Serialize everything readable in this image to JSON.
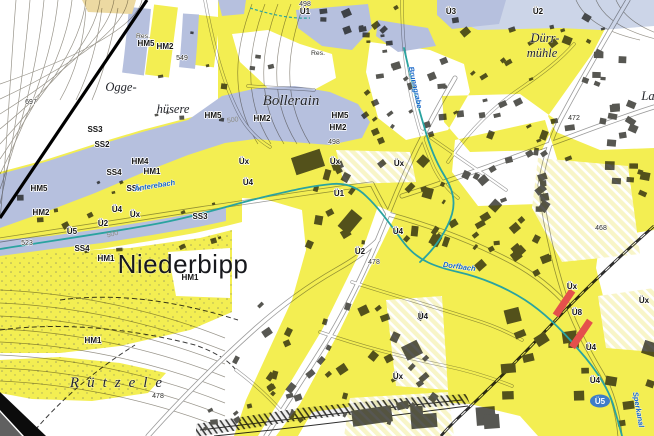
{
  "map": {
    "colors": {
      "yellow": "#f3ee52",
      "paleYellow": "#f8f5c8",
      "blue": "#b6c0de",
      "lightBlue": "#ccd5e8",
      "tan": "#ecd9a2",
      "red": "#e4504c",
      "stream": "#2aa3a0",
      "waterText": "#1565c8",
      "building": "#575752",
      "roadCasing": "#9b9b9b",
      "contour": "#98948a",
      "dots": "#8e9160"
    },
    "labels": {
      "hazard_codes": [
        {
          "t": "HM5",
          "x": 146,
          "y": 46
        },
        {
          "t": "HM2",
          "x": 165,
          "y": 49
        },
        {
          "t": "Ü1",
          "x": 305,
          "y": 14
        },
        {
          "t": "Ü3",
          "x": 451,
          "y": 14
        },
        {
          "t": "Ü2",
          "x": 538,
          "y": 14
        },
        {
          "t": "HM5",
          "x": 213,
          "y": 118
        },
        {
          "t": "HM2",
          "x": 262,
          "y": 121
        },
        {
          "t": "HM5",
          "x": 340,
          "y": 118
        },
        {
          "t": "HM2",
          "x": 338,
          "y": 130
        },
        {
          "t": "SS3",
          "x": 95,
          "y": 132
        },
        {
          "t": "SS2",
          "x": 102,
          "y": 147
        },
        {
          "t": "HM4",
          "x": 140,
          "y": 164
        },
        {
          "t": "HM1",
          "x": 152,
          "y": 174
        },
        {
          "t": "SS4",
          "x": 114,
          "y": 175
        },
        {
          "t": "SSx",
          "x": 134,
          "y": 191
        },
        {
          "t": "HM5",
          "x": 39,
          "y": 191
        },
        {
          "t": "HM2",
          "x": 41,
          "y": 215
        },
        {
          "t": "Üx",
          "x": 244,
          "y": 164
        },
        {
          "t": "Üx",
          "x": 335,
          "y": 164
        },
        {
          "t": "Üx",
          "x": 399,
          "y": 166
        },
        {
          "t": "Ü4",
          "x": 248,
          "y": 185
        },
        {
          "t": "Ü1",
          "x": 339,
          "y": 196
        },
        {
          "t": "Ü4",
          "x": 117,
          "y": 212
        },
        {
          "t": "Üx",
          "x": 135,
          "y": 217
        },
        {
          "t": "Ü2",
          "x": 103,
          "y": 226
        },
        {
          "t": "Ü5",
          "x": 72,
          "y": 234
        },
        {
          "t": "SS3",
          "x": 200,
          "y": 219
        },
        {
          "t": "SS4",
          "x": 82,
          "y": 251
        },
        {
          "t": "HM1",
          "x": 106,
          "y": 261
        },
        {
          "t": "HM1",
          "x": 190,
          "y": 280
        },
        {
          "t": "HM1",
          "x": 93,
          "y": 343
        },
        {
          "t": "Ü2",
          "x": 360,
          "y": 254
        },
        {
          "t": "Ü4",
          "x": 398,
          "y": 234
        },
        {
          "t": "Ü4",
          "x": 423,
          "y": 319
        },
        {
          "t": "Üx",
          "x": 398,
          "y": 379
        },
        {
          "t": "Üx",
          "x": 572,
          "y": 289
        },
        {
          "t": "Üx",
          "x": 644,
          "y": 303
        },
        {
          "t": "Ü8",
          "x": 577,
          "y": 315
        },
        {
          "t": "Ü4",
          "x": 591,
          "y": 350
        },
        {
          "t": "Ü4",
          "x": 595,
          "y": 383
        }
      ],
      "elevations": [
        {
          "t": "549",
          "x": 182,
          "y": 60
        },
        {
          "t": "697",
          "x": 31,
          "y": 104
        },
        {
          "t": "498",
          "x": 305,
          "y": 6
        },
        {
          "t": "498",
          "x": 334,
          "y": 144
        },
        {
          "t": "500",
          "x": 233,
          "y": 122,
          "rot": -8,
          "cls": "muted"
        },
        {
          "t": "500",
          "x": 113,
          "y": 236,
          "rot": -15,
          "cls": "muted"
        },
        {
          "t": "523",
          "x": 27,
          "y": 245
        },
        {
          "t": "478",
          "x": 374,
          "y": 264
        },
        {
          "t": "478",
          "x": 158,
          "y": 398
        },
        {
          "t": "472",
          "x": 574,
          "y": 120
        },
        {
          "t": "468",
          "x": 601,
          "y": 230
        }
      ],
      "water_names": [
        {
          "t": "Änterebach",
          "x": 155,
          "y": 188,
          "rot": -9
        },
        {
          "t": "Brunngrabe",
          "x": 413,
          "y": 88,
          "rot": 78
        },
        {
          "t": "Dorfbach",
          "x": 459,
          "y": 269,
          "rot": 8
        },
        {
          "t": "Sperkanal",
          "x": 636,
          "y": 410,
          "rot": 80
        }
      ],
      "place_names": [
        {
          "t": "Ogge-",
          "x": 121,
          "y": 91
        },
        {
          "t": "hüsere",
          "x": 173,
          "y": 113
        },
        {
          "t": "Bollerain",
          "x": 291,
          "y": 105,
          "cls": "p-md"
        },
        {
          "t": "Dürr-",
          "x": 545,
          "y": 42
        },
        {
          "t": "mühle",
          "x": 542,
          "y": 57
        },
        {
          "t": "Niederbipp",
          "x": 183,
          "y": 273,
          "cls": "p-big"
        },
        {
          "t": "Rützele",
          "x": 120,
          "y": 387,
          "cls": "p-md p-sp"
        },
        {
          "t": "La",
          "x": 648,
          "y": 100
        }
      ],
      "misc": [
        {
          "t": "Res.",
          "x": 143,
          "y": 38
        },
        {
          "t": "Res.",
          "x": 318,
          "y": 55
        }
      ],
      "stop_badge": {
        "t": "Ü5",
        "x": 600,
        "y": 402
      }
    }
  }
}
